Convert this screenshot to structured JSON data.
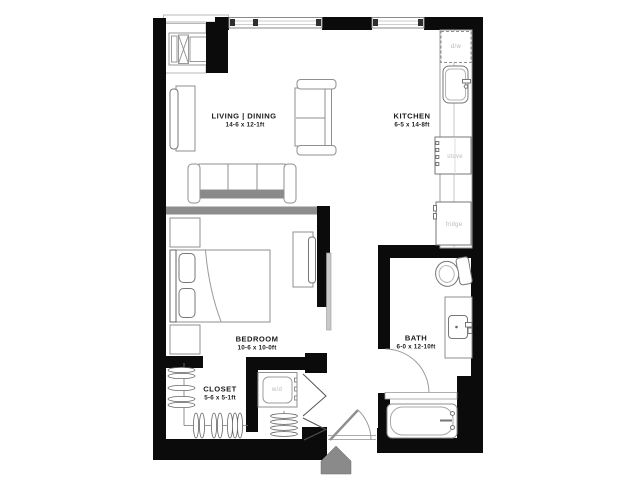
{
  "floor_plan": {
    "rooms": {
      "living_dining": {
        "name": "LIVING | DINING",
        "dims": "14-6 x 12-1ft"
      },
      "kitchen": {
        "name": "KITCHEN",
        "dims": "6-5 x 14-8ft"
      },
      "bedroom": {
        "name": "BEDROOM",
        "dims": "10-6 x 10-0ft"
      },
      "closet": {
        "name": "CLOSET",
        "dims": "5-6 x 5-1ft"
      },
      "bath": {
        "name": "BATH",
        "dims": "6-0 x 12-10ft"
      }
    },
    "appliances": {
      "dishwasher": "d/w",
      "stove": "stove",
      "fridge": "fridge",
      "washer_dryer": "w/d"
    },
    "colors": {
      "wall": "#0b0b0b",
      "partition_wall": "#8d8d8d",
      "entry_arrow": "#8a8a8a",
      "appliance_label": "#b9b9b9",
      "furniture_outline": "#8f8f8f"
    }
  }
}
